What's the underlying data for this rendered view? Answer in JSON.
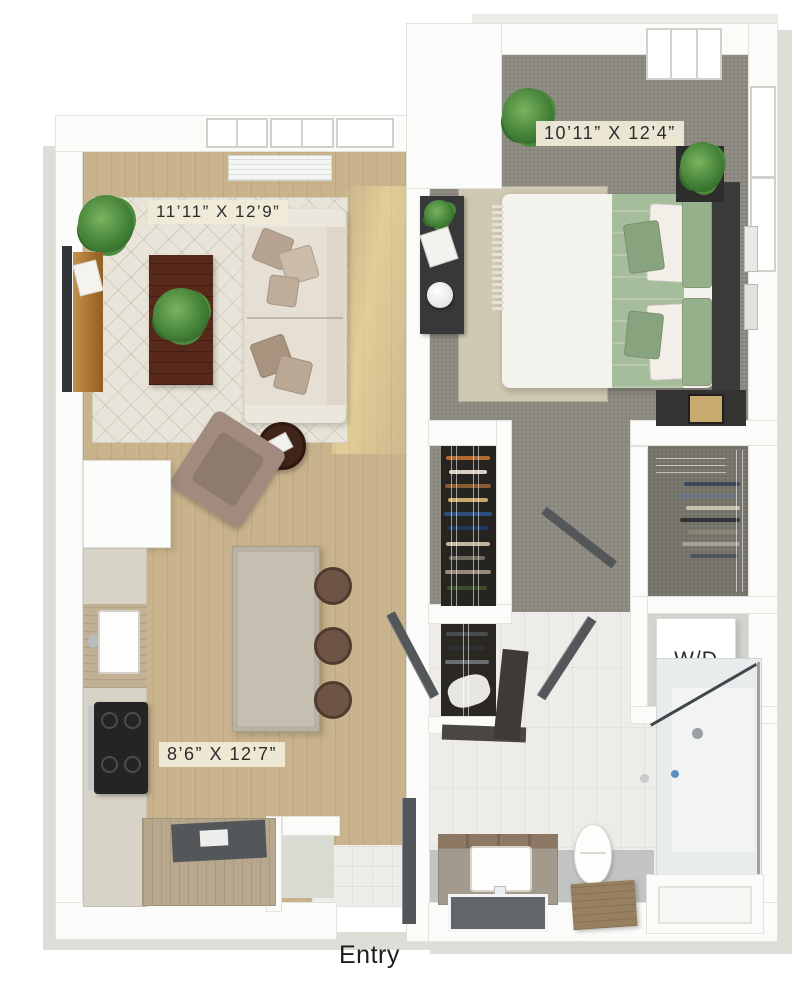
{
  "rooms": {
    "living_room": {
      "dimensions": "11’11” X 12’9”"
    },
    "bedroom": {
      "dimensions": "10’11” X 12’4”"
    },
    "kitchen": {
      "dimensions": "8’6” X 12’7”"
    }
  },
  "labels": {
    "washer_dryer": "W/D",
    "entry": "Entry"
  },
  "colors": {
    "background": "#ffffff",
    "wall": "#fbfbf9",
    "exterior_face": "#dcded7",
    "wood_floor": "#c9b38c",
    "carpet": "#908d84",
    "bath_tile": "#edece8",
    "rug": "#e8e4d9",
    "sofa": "#e6e0d4",
    "bedding_green": "#a6bd9b",
    "label_bg": "#f0ead8",
    "label_text": "#2c2c2c"
  }
}
